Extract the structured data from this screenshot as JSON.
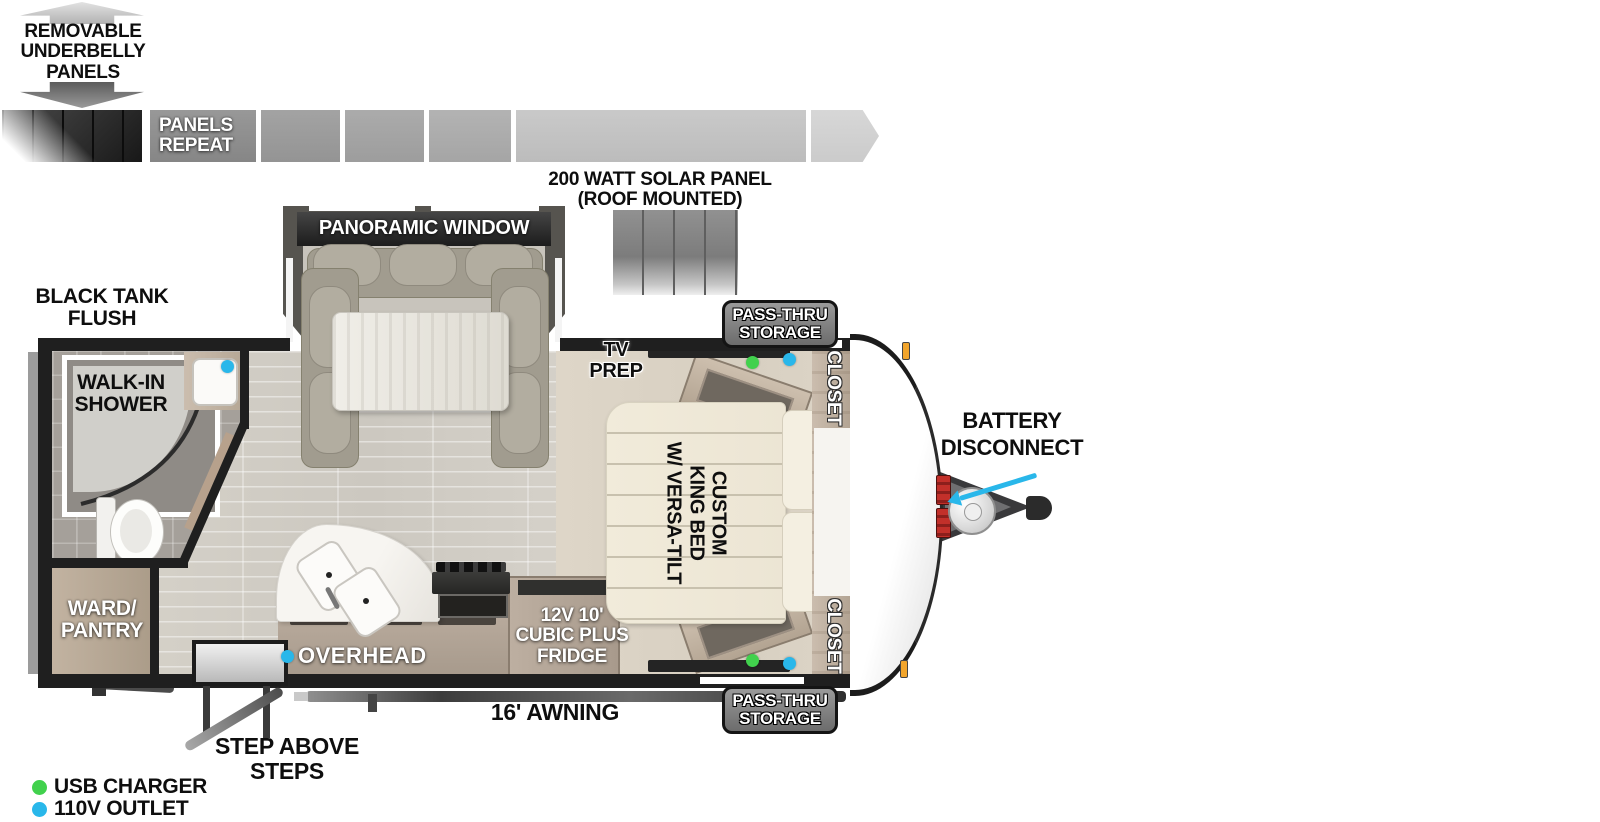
{
  "underbelly": {
    "title": "REMOVABLE\nUNDERBELLY\nPANELS",
    "panels_repeat": "PANELS\nREPEAT"
  },
  "solar": {
    "title": "200 WATT SOLAR PANEL\n(ROOF MOUNTED)"
  },
  "exterior": {
    "black_tank_flush": "BLACK TANK\nFLUSH",
    "pass_thru_top": "PASS-THRU\nSTORAGE",
    "pass_thru_bottom": "PASS-THRU\nSTORAGE",
    "battery_disconnect": "BATTERY\nDISCONNECT",
    "awning": "16' AWNING",
    "step_above_steps": "STEP ABOVE STEPS"
  },
  "interior": {
    "panoramic_window": "PANORAMIC WINDOW",
    "walk_in_shower": "WALK-IN\nSHOWER",
    "ward_pantry": "WARD/\nPANTRY",
    "overhead": "OVERHEAD",
    "fridge": "12V 10'\nCUBIC PLUS\nFRIDGE",
    "tv_prep": "TV\nPREP",
    "closet_top": "CLOSET",
    "closet_bottom": "CLOSET",
    "king_bed": "CUSTOM\nKING BED\nW/ VERSA-TILT"
  },
  "legend": {
    "usb_charger": "USB CHARGER",
    "outlet_110v": "110V OUTLET"
  },
  "colors": {
    "usb_dot": "#41d14d",
    "outlet_dot": "#29b7ea",
    "pointer_arrow": "#29b7ea"
  }
}
